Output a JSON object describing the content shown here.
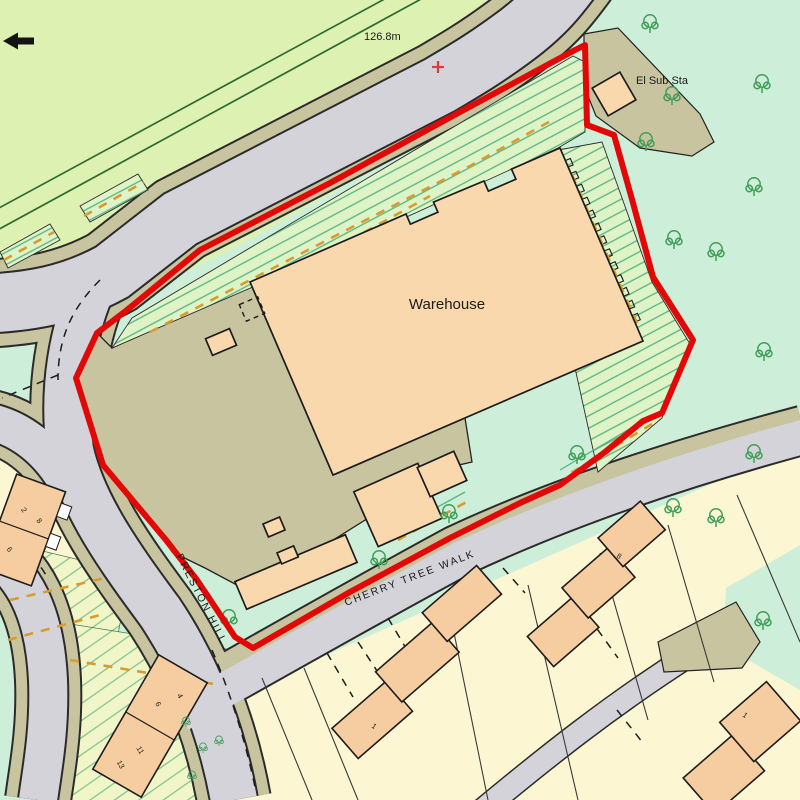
{
  "map": {
    "labels": {
      "warehouse": "Warehouse",
      "substation": "El Sub Sta",
      "spot_height": "126.8m"
    },
    "streets": {
      "cherry_tree_walk": "CHERRY TREE WALK",
      "preston_hill": "PRESTON HILL"
    },
    "house_numbers": {
      "terrace_west": [
        "2",
        "8",
        "6"
      ],
      "terrace_southwest": [
        "4",
        "6",
        "11",
        "13"
      ],
      "plot_south": "1",
      "terrace_east": "8",
      "plot_southeast": "1"
    },
    "icons": {
      "tree": "deciduous-tree",
      "shrub": "shrub",
      "north_arrow": "direction-arrow-west",
      "spot_height_marker": "red-cross",
      "site_boundary": "red-outline"
    },
    "colors": {
      "field": "#ddf2b2",
      "meadow": "#cdeed8",
      "road": "#d5d3da",
      "verge": "#c8c4a0",
      "building": "#fad8ae",
      "building_dark": "#f6cda1",
      "plot": "#fdf6d2",
      "boundary_red": "#e20808",
      "hatch_line": "#57b282",
      "access_dash": "#d89b30",
      "tree": "#3f9e57",
      "field_line": "#2f6b2f"
    }
  }
}
